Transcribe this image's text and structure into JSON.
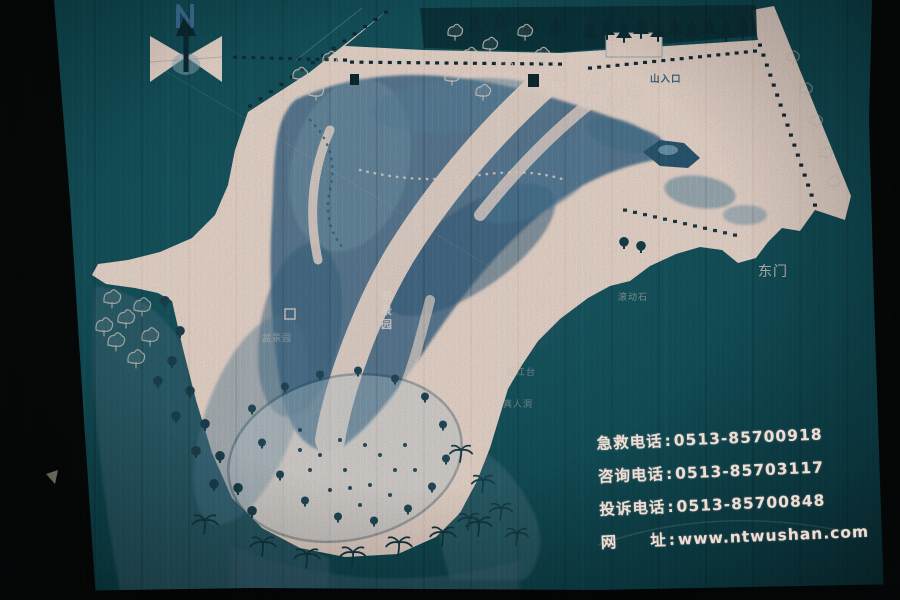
{
  "scene": {
    "kind": "photograph of a painted scenic-area guide map sign board",
    "palette": {
      "board_teal": "#14525c",
      "board_teal_light": "#1c626c",
      "map_cream": "#f2dfd4",
      "hill_blue": "#476f8e",
      "tree_dark": "#0d3038",
      "label_pink": "#f0ddd3",
      "photo_edge_black": "#070a0a"
    }
  },
  "north_indicator": {
    "icon": "north-arrow",
    "letter": "N"
  },
  "map_labels": [
    {
      "id": "entrance",
      "text": "山入口",
      "x": 650,
      "y": 82,
      "size": 9.5,
      "color": "#2f5e80",
      "opacity": 0.95,
      "vertical": false,
      "weight": "bold"
    },
    {
      "id": "east-gate",
      "text": "东门",
      "x": 758,
      "y": 276,
      "size": 14,
      "color": "#ecd9d0",
      "opacity": 0.82,
      "vertical": false,
      "weight": "normal"
    },
    {
      "id": "rolling-stone",
      "text": "滚动石",
      "x": 618,
      "y": 300,
      "size": 9,
      "color": "#e0d0c9",
      "opacity": 0.55,
      "vertical": false,
      "weight": "normal"
    },
    {
      "id": "cuijing-garden",
      "text": "翠景园",
      "x": 381,
      "y": 300,
      "size": 11,
      "color": "#f3e4dc",
      "opacity": 0.82,
      "vertical": true,
      "weight": "bold"
    },
    {
      "id": "bonsai-garden",
      "text": "盆景园",
      "x": 262,
      "y": 341,
      "size": 9,
      "color": "#e6d7d0",
      "opacity": 0.5,
      "vertical": false,
      "weight": "normal"
    },
    {
      "id": "lookout-terrace",
      "text": "望江台",
      "x": 506,
      "y": 375,
      "size": 9,
      "color": "#dccdc7",
      "opacity": 0.5,
      "vertical": false,
      "weight": "normal"
    },
    {
      "id": "immortal-cave",
      "text": "真人洞",
      "x": 503,
      "y": 407,
      "size": 9,
      "color": "#dccdc7",
      "opacity": 0.5,
      "vertical": false,
      "weight": "normal"
    }
  ],
  "contact_info": {
    "separator": ":",
    "color": "#f0ddd3",
    "lines": [
      {
        "label": "急救电话",
        "value": "0513-85700918"
      },
      {
        "label": "咨询电话",
        "value": "0513-85703117"
      },
      {
        "label": "投诉电话",
        "value": "0513-85700848"
      },
      {
        "label": "网　　址",
        "value": "www.ntwushan.com"
      }
    ]
  }
}
